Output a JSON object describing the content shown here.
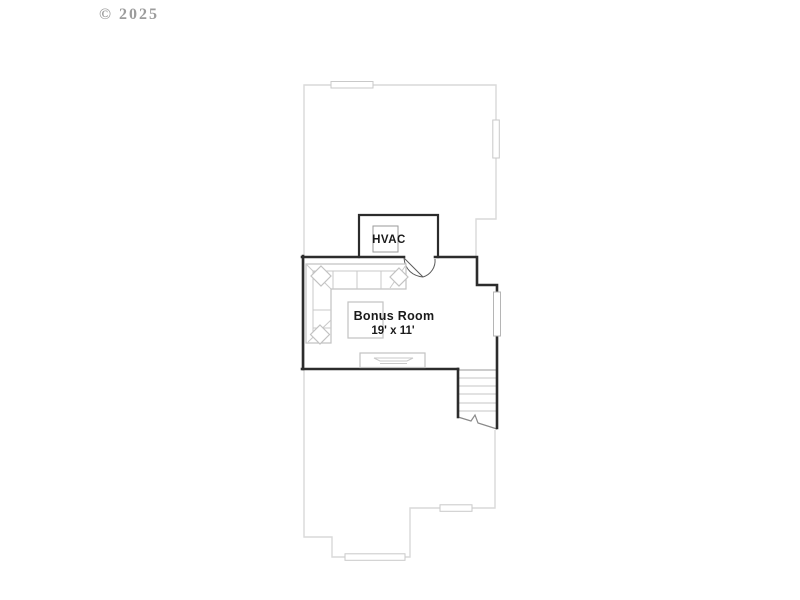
{
  "watermark": {
    "text": "© 2025"
  },
  "plan": {
    "type": "residential-floor-plan-upper-level",
    "rooms": [
      {
        "name": "Bonus Room",
        "dimensions": "19' x 11'"
      },
      {
        "name": "HVAC",
        "dimensions": ""
      }
    ],
    "labels": {
      "hvac": "HVAC",
      "bonus_room": "Bonus Room",
      "bonus_room_dimensions": "19' x 11'"
    },
    "features": [
      "ghost-outline-of-floor-below",
      "sectional-sofa",
      "accent-pillows",
      "ottoman",
      "media-console-with-tv",
      "hvac-unit",
      "double-door",
      "staircase-with-break-line",
      "windows"
    ],
    "colors": {
      "walls": "#2c2c2c",
      "ghost_outline": "#d9d9d9",
      "furniture": "#c2c2c2",
      "text": "#1a1a1a",
      "watermark": "#9c9c9c",
      "background": "#ffffff"
    }
  }
}
